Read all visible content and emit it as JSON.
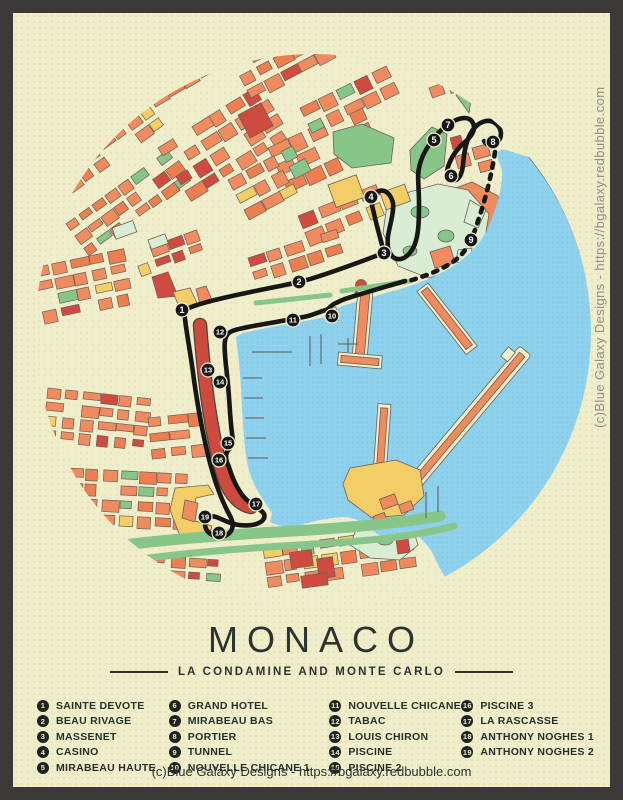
{
  "poster": {
    "title": "MONACO",
    "subtitle": "LA CONDAMINE AND MONTE CARLO",
    "copyright_bottom": "(c)Blue Galaxy Designs -  https://bgalaxy.redbubble.com",
    "copyright_side": "(c)Blue Galaxy Designs -  https://bgalaxy.redbubble.com"
  },
  "legend": {
    "items": [
      {
        "number": "1",
        "label": "SAINTE DEVOTE"
      },
      {
        "number": "2",
        "label": "BEAU RIVAGE"
      },
      {
        "number": "3",
        "label": "MASSENET"
      },
      {
        "number": "4",
        "label": "CASINO"
      },
      {
        "number": "5",
        "label": "MIRABEAU HAUTE"
      },
      {
        "number": "6",
        "label": "GRAND HOTEL"
      },
      {
        "number": "7",
        "label": "MIRABEAU BAS"
      },
      {
        "number": "8",
        "label": "PORTIER"
      },
      {
        "number": "9",
        "label": "TUNNEL"
      },
      {
        "number": "10",
        "label": "NOUVELLE CHICANE 1"
      },
      {
        "number": "11",
        "label": "NOUVELLE CHICANE 2"
      },
      {
        "number": "12",
        "label": "TABAC"
      },
      {
        "number": "13",
        "label": "LOUIS CHIRON"
      },
      {
        "number": "14",
        "label": "PISCINE"
      },
      {
        "number": "15",
        "label": "PISCINE 2"
      },
      {
        "number": "16",
        "label": "PISCINE 3"
      },
      {
        "number": "17",
        "label": "LA RASCASSE"
      },
      {
        "number": "18",
        "label": "ANTHONY NOGHES 1"
      },
      {
        "number": "19",
        "label": "ANTHONY NOGHES 2"
      }
    ]
  },
  "colors": {
    "frame": "#3b3a39",
    "background": "#efedca",
    "water": "#8ed1ec",
    "building": "#f08a5f",
    "building_red": "#cf4b3f",
    "building_yellow": "#f3ce67",
    "park_green": "#87c588",
    "park_mint": "#d9ecd4",
    "track": "#171717",
    "text_dark": "#2b3330",
    "text_gray": "#8f8f85"
  }
}
